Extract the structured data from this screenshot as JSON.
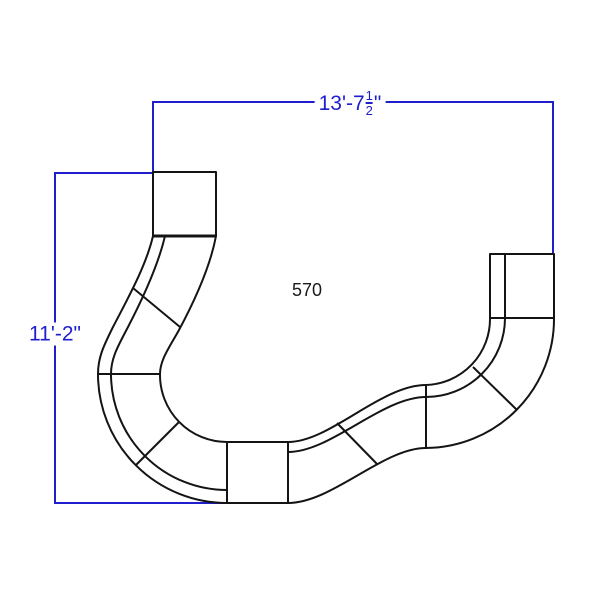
{
  "drawing": {
    "type": "furniture-configuration-dimension-diagram",
    "model_label": "570",
    "dimensions": {
      "width": {
        "main": "13'-7",
        "fraction_numerator": "1",
        "fraction_denominator": "2",
        "suffix": "\""
      },
      "height": {
        "label": "11'-2\""
      }
    },
    "colors": {
      "dimension_blue": "#1e1ecd",
      "outline_black": "#141414",
      "background": "#ffffff"
    }
  }
}
